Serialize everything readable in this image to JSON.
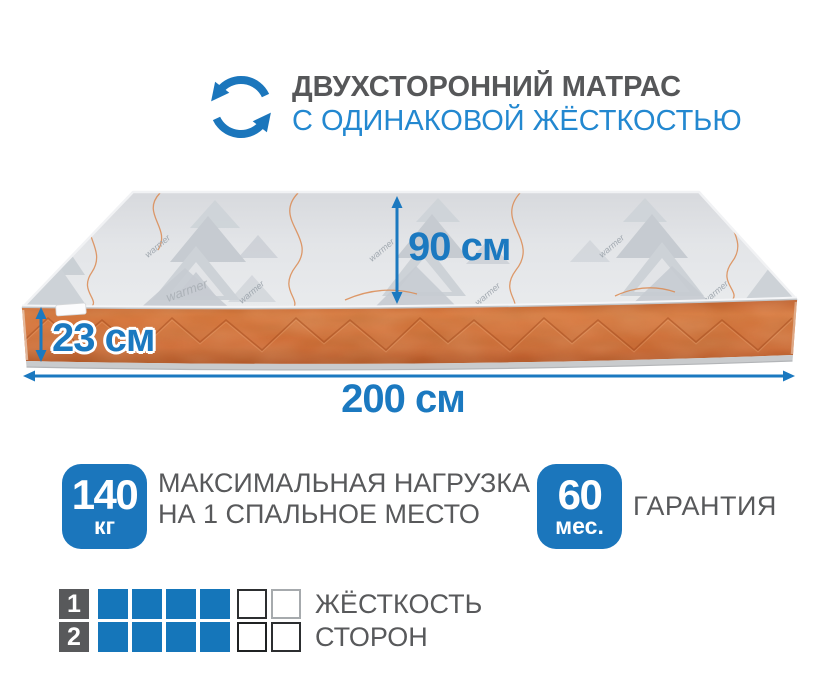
{
  "header": {
    "title": "ДВУХСТОРОННИЙ МАТРАС",
    "subtitle": "С ОДИНАКОВОЙ ЖЁСТКОСТЬЮ"
  },
  "mattress": {
    "width_label": "90 см",
    "height_label": "23 см",
    "length_label": "200 см",
    "pattern_text": "warmer"
  },
  "features": [
    {
      "badge_value": "140",
      "badge_unit": "кг",
      "lines": [
        "МАКСИМАЛЬНАЯ НАГРУЗКА",
        "НА 1 СПАЛЬНОЕ МЕСТО"
      ]
    },
    {
      "badge_value": "60",
      "badge_unit": "мес.",
      "lines": [
        "ГАРАНТИЯ"
      ]
    }
  ],
  "ratings": {
    "scale_max": 6,
    "rows": [
      {
        "num": "1",
        "filled": 4,
        "empty_borders": [
          "#2c2e30",
          "#a6aaad"
        ],
        "label": "ЖЁСТКОСТЬ"
      },
      {
        "num": "2",
        "filled": 4,
        "empty_borders": [
          "#1f2122",
          "#2c2e30"
        ],
        "label": "СТОРОН"
      }
    ]
  },
  "colors": {
    "accent_blue": "#1b76bc",
    "subtitle_blue": "#2388d0",
    "text_gray": "#58595b",
    "square_blue": "#1576ba",
    "side_orange": "#d06a35"
  }
}
